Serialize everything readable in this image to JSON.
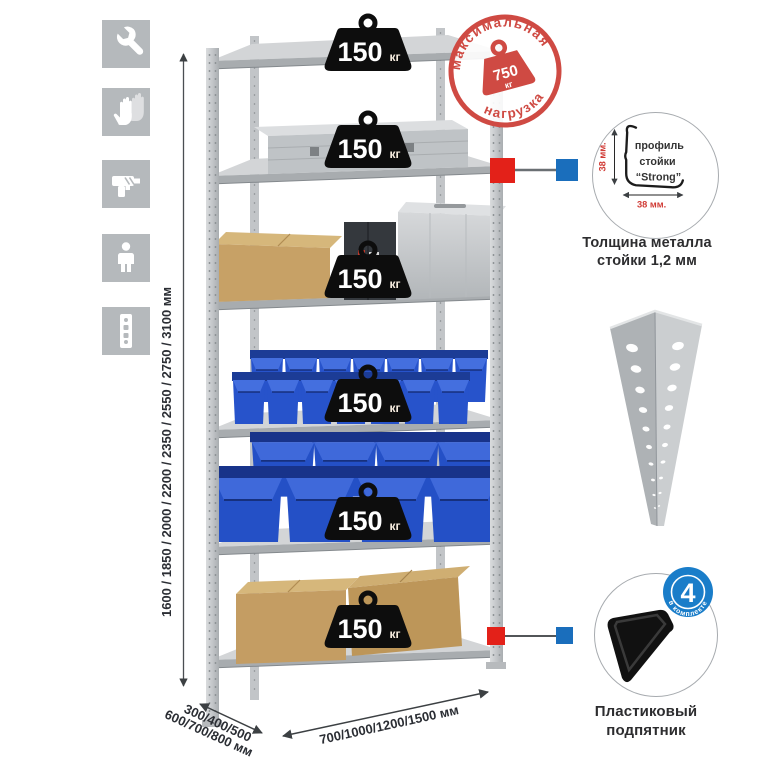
{
  "dimensions": {
    "height": "1600 / 1850 / 2000 / 2200 / 2350 / 2550 / 2750 / 3100 мм",
    "depth_line1": "300/400/500",
    "depth_line2": "600/700/800 мм",
    "width": "700/1000/1200/1500 мм"
  },
  "stamp": {
    "arc_top": "максимальная",
    "arc_bottom": "нагрузка",
    "value": "750",
    "unit": "кг"
  },
  "shelves": [
    {
      "load": "150",
      "unit": "кг"
    },
    {
      "load": "150",
      "unit": "кг"
    },
    {
      "load": "150",
      "unit": "кг"
    },
    {
      "load": "150",
      "unit": "кг"
    },
    {
      "load": "150",
      "unit": "кг"
    },
    {
      "load": "150",
      "unit": "кг"
    }
  ],
  "profile_callout": {
    "dim_vertical": "38 мм.",
    "dim_horizontal": "38 мм.",
    "label1": "профиль",
    "label2": "стойки",
    "label3": "“Strong”",
    "caption1": "Толщина металла",
    "caption2": "стойки 1,2 мм"
  },
  "foot_callout": {
    "badge_value": "4",
    "badge_text": "в комплекте",
    "caption1": "Пластиковый",
    "caption2": "подпятник"
  },
  "icons": [
    {
      "name": "wrench-icon"
    },
    {
      "name": "gloves-icon"
    },
    {
      "name": "drill-icon"
    },
    {
      "name": "person-icon"
    },
    {
      "name": "rack-post-icon"
    }
  ],
  "colors": {
    "stamp_red": "#cf4a43",
    "marker_red": "#e32119",
    "marker_blue": "#1a6ebc",
    "bin_blue": "#2450c6",
    "cardboard": "#c7a166",
    "metal_light": "#d3d5d7",
    "metal_dark": "#a8acaf",
    "icon_tile_gray": "#b5b9bc"
  }
}
